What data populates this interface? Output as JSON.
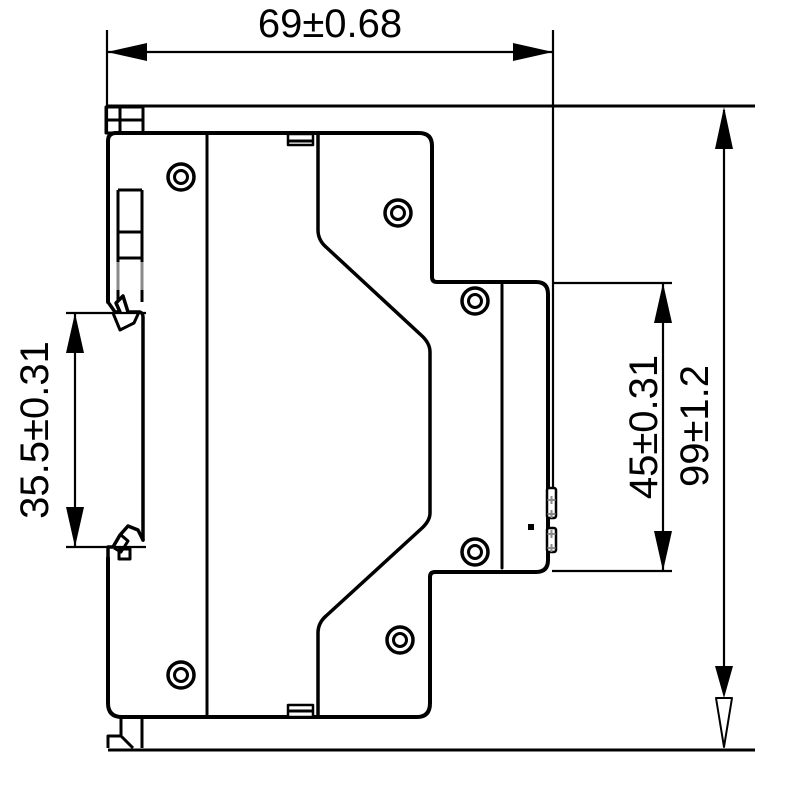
{
  "drawing": {
    "dimensions": {
      "overall_width": {
        "label": "69±0.68"
      },
      "overall_height": {
        "label": "99±1.2"
      },
      "din_rail_span": {
        "label": "35.5±0.31"
      },
      "front_section_height": {
        "label": "45±0.31"
      }
    },
    "colors": {
      "line": "#000000",
      "background": "#ffffff",
      "detail_gray": "#8a8a8a"
    }
  }
}
